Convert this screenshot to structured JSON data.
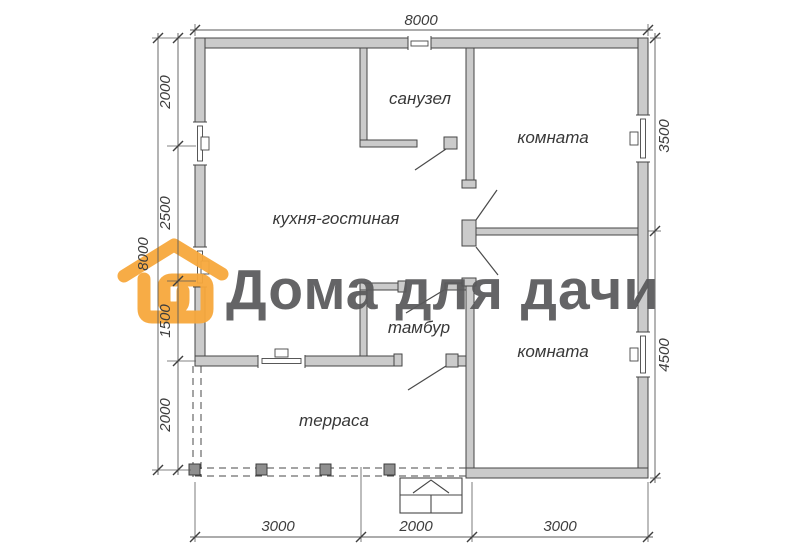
{
  "watermark": {
    "brand_text": "Дома для дачи",
    "logo_color": "#F7A83C",
    "text_color": "#59595B"
  },
  "plan": {
    "rooms": [
      {
        "label": "санузел"
      },
      {
        "label": "комната"
      },
      {
        "label": "кухня-гостиная"
      },
      {
        "label": "тамбур"
      },
      {
        "label": "комната"
      },
      {
        "label": "терраса"
      }
    ],
    "dimensions": {
      "top_total": "8000",
      "left_total": "8000",
      "left_chain": [
        "2000",
        "2500",
        "1500",
        "2000"
      ],
      "right_chain": [
        "3500",
        "4500"
      ],
      "bottom_chain": [
        "3000",
        "2000",
        "3000"
      ]
    },
    "colors": {
      "wall_fill": "#CBCBCB",
      "line": "#4A4A4A",
      "background": "#FFFFFF"
    }
  }
}
